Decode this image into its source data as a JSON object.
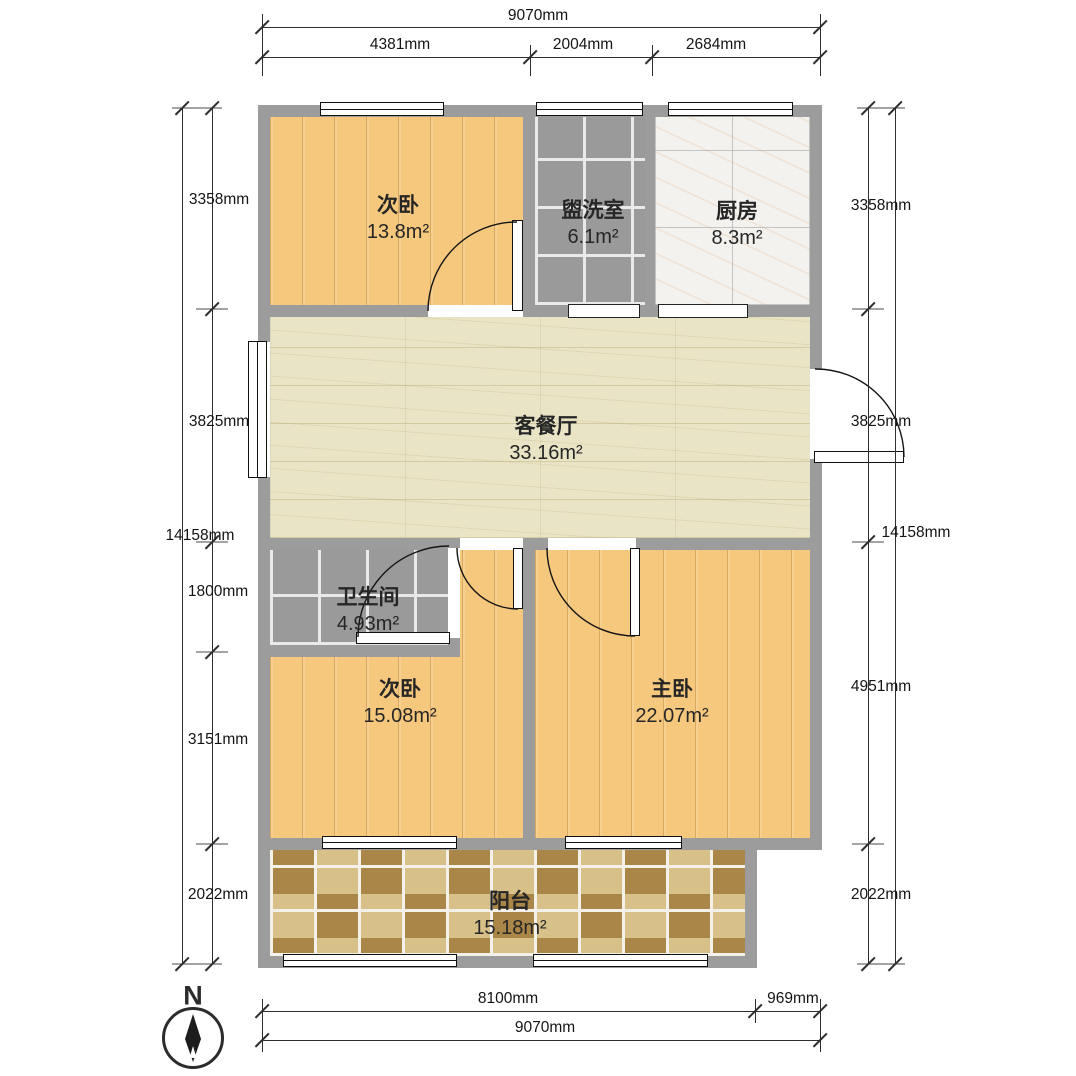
{
  "rooms": {
    "bedroom_top": {
      "name": "次卧",
      "area": "13.8m²"
    },
    "washroom": {
      "name": "盥洗室",
      "area": "6.1m²"
    },
    "kitchen": {
      "name": "厨房",
      "area": "8.3m²"
    },
    "living": {
      "name": "客餐厅",
      "area": "33.16m²"
    },
    "bathroom": {
      "name": "卫生间",
      "area": "4.93m²"
    },
    "bedroom_left": {
      "name": "次卧",
      "area": "15.08m²"
    },
    "master": {
      "name": "主卧",
      "area": "22.07m²"
    },
    "balcony": {
      "name": "阳台",
      "area": "15.18m²"
    }
  },
  "dimensions": {
    "top_overall": "9070mm",
    "top_segments": [
      "4381mm",
      "2004mm",
      "2684mm"
    ],
    "left_overall": "14158mm",
    "left_segments": [
      "3358mm",
      "3825mm",
      "1800mm",
      "3151mm",
      "2022mm"
    ],
    "right_overall": "14158mm",
    "right_segments": [
      "3358mm",
      "3825mm",
      "4951mm",
      "2022mm"
    ],
    "bottom_segments": [
      "8100mm",
      "969mm"
    ],
    "bottom_overall": "9070mm"
  },
  "compass": {
    "label": "N"
  },
  "colors": {
    "wall": "#9c9c9c",
    "wood_floor": "#f6c87e",
    "living_marble": "#e9e4c5",
    "kitchen_tile": "#f4f2ee",
    "gray_tile": "#9a9a9a",
    "balcony_tile_light": "#d8c189",
    "balcony_tile_dark": "#aa8748"
  }
}
